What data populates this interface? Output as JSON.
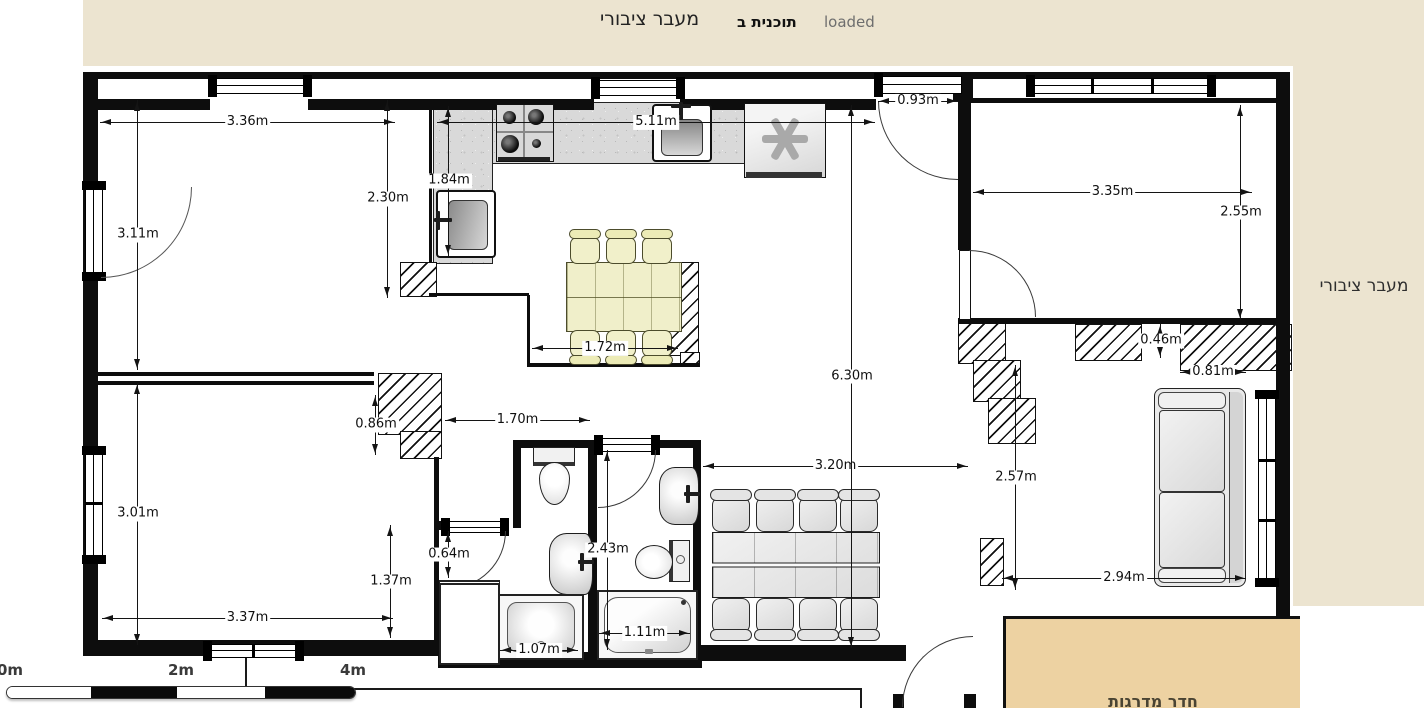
{
  "topbar": {
    "area_label": "מעבר ציבורי",
    "plan_name": "תוכנית ב",
    "status": "loaded"
  },
  "labels": {
    "side_corridor": "מעבר ציבורי",
    "stairwell": "חדר מדרגות"
  },
  "scale_bar": {
    "tick_0": "0m",
    "tick_2": "2m",
    "tick_4": "4m"
  },
  "dims": {
    "d336": "3.36m",
    "d311": "3.11m",
    "d230": "2.30m",
    "d184": "1.84m",
    "d511": "5.11m",
    "d093": "0.93m",
    "d335": "3.35m",
    "d255": "2.55m",
    "d172": "1.72m",
    "d630": "6.30m",
    "d046": "0.46m",
    "d081": "0.81m",
    "d086": "0.86m",
    "d170": "1.70m",
    "d320": "3.20m",
    "d257": "2.57m",
    "d301": "3.01m",
    "d064": "0.64m",
    "d243": "2.43m",
    "d137": "1.37m",
    "d337": "3.37m",
    "d107": "1.07m",
    "d111": "1.11m",
    "d294": "2.94m"
  },
  "colors": {
    "topbar_bg": "#ece4d0",
    "side_strip_bg": "#ece4d0",
    "stairwell_bg": "#edd2a2",
    "wall": "#0d0d0d",
    "dining_cream": "#f0efca",
    "furniture_gray": "#e6e6e6",
    "counter_granite": "#d9d9d9"
  }
}
